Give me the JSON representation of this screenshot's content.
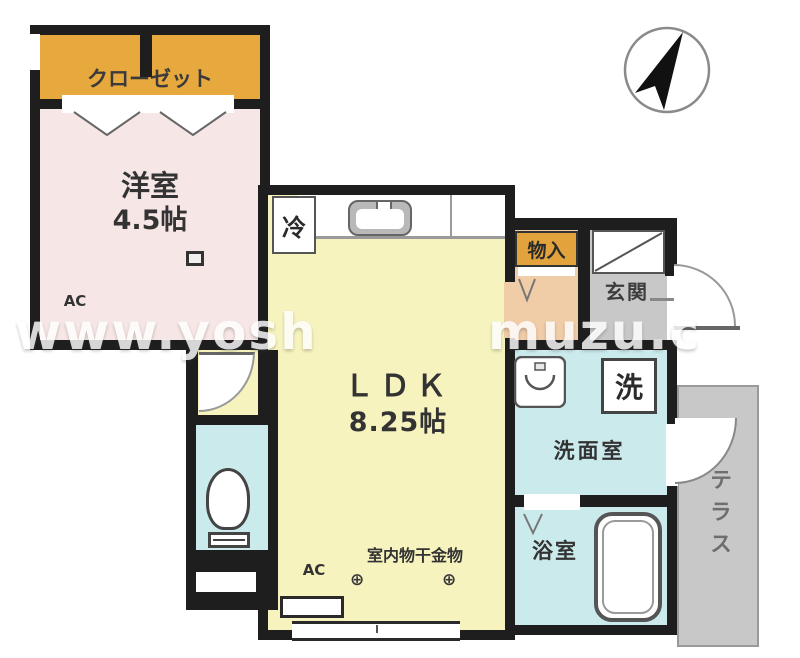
{
  "watermark": {
    "left": "www.yosh",
    "right": "muzu.c"
  },
  "closet": {
    "label": "クローゼット"
  },
  "western_room": {
    "label": "洋室",
    "size": "4.5帖",
    "ac_label": "AC"
  },
  "ldk": {
    "label": "ＬＤＫ",
    "size": "8.25帖",
    "ac_label": "AC",
    "fridge_label": "冷",
    "drying_label": "室内物干金物",
    "hook_symbol": "⊕"
  },
  "storage": {
    "label": "物入"
  },
  "entrance": {
    "label": "玄関"
  },
  "washroom": {
    "label": "洗面室",
    "washer_label": "洗"
  },
  "bathroom": {
    "label": "浴室"
  },
  "terrace": {
    "label": "テラス"
  },
  "colors": {
    "wall": "#1e1e1e",
    "closet_fill": "#E7A83E",
    "western_fill": "#F7E6E6",
    "ldk_fill": "#F6F3BE",
    "hall_fill": "#F0CCA7",
    "entrance_fill": "#C8C8C8",
    "wet_room_fill": "#CBEAEC",
    "terrace_fill": "#C8C8C8"
  }
}
